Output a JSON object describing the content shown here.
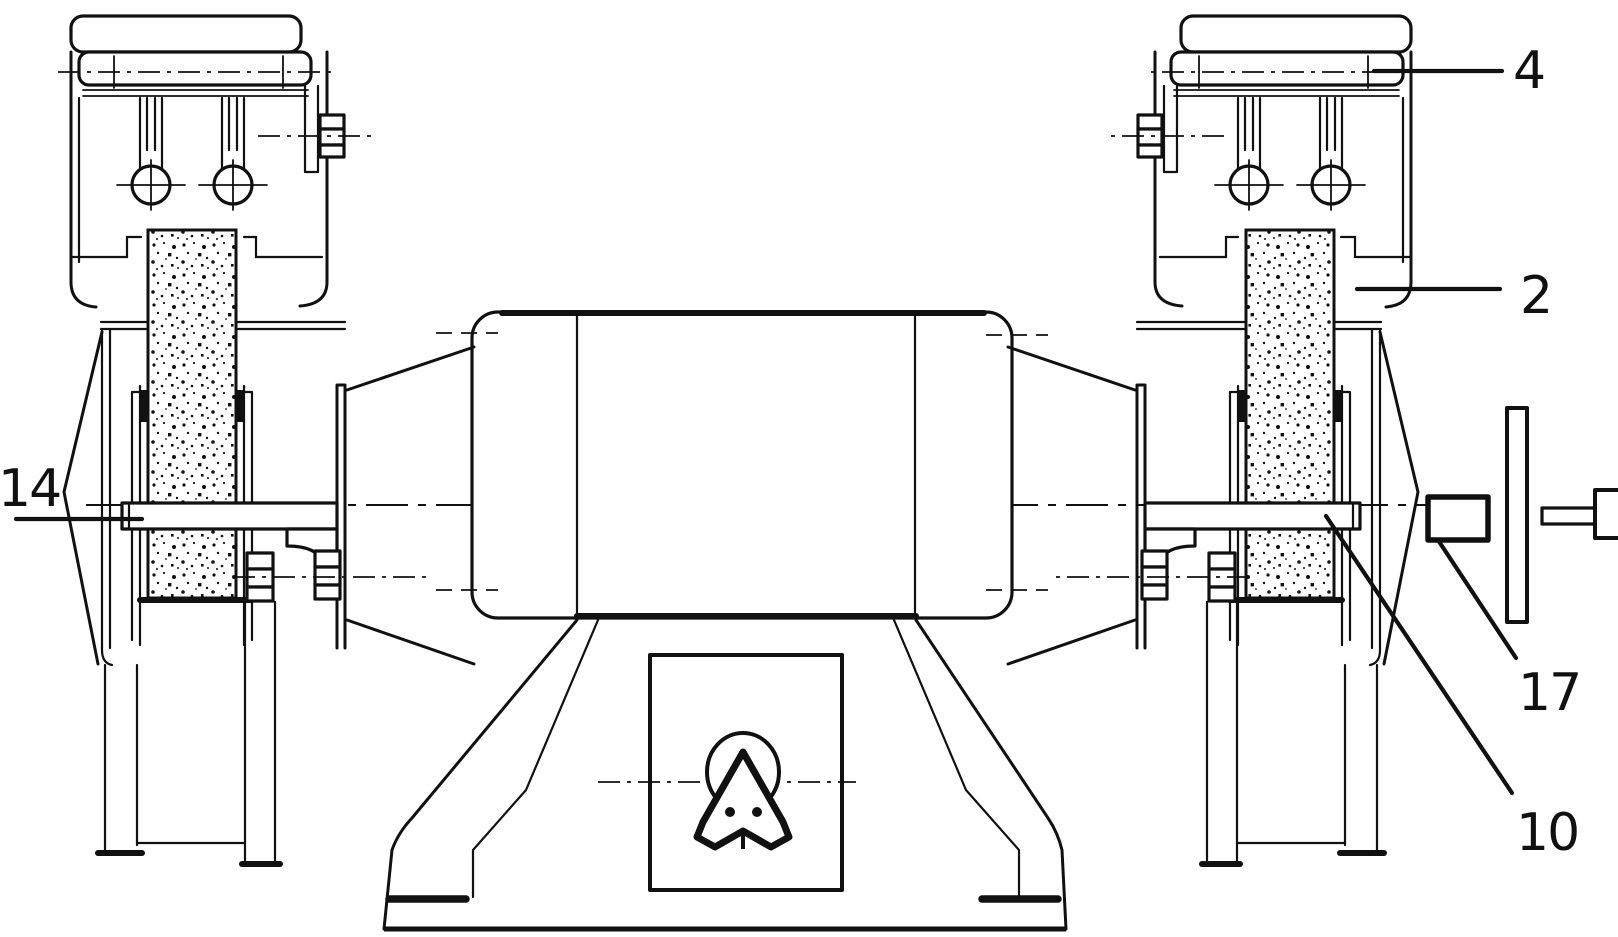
{
  "figure": {
    "type": "technical-line-drawing",
    "description_visible": "",
    "ink_color": "#111111",
    "paper_color": "#ffffff",
    "labels": [
      {
        "text": "4"
      },
      {
        "text": "2"
      },
      {
        "text": "14"
      },
      {
        "text": "17"
      },
      {
        "text": "10"
      }
    ]
  }
}
